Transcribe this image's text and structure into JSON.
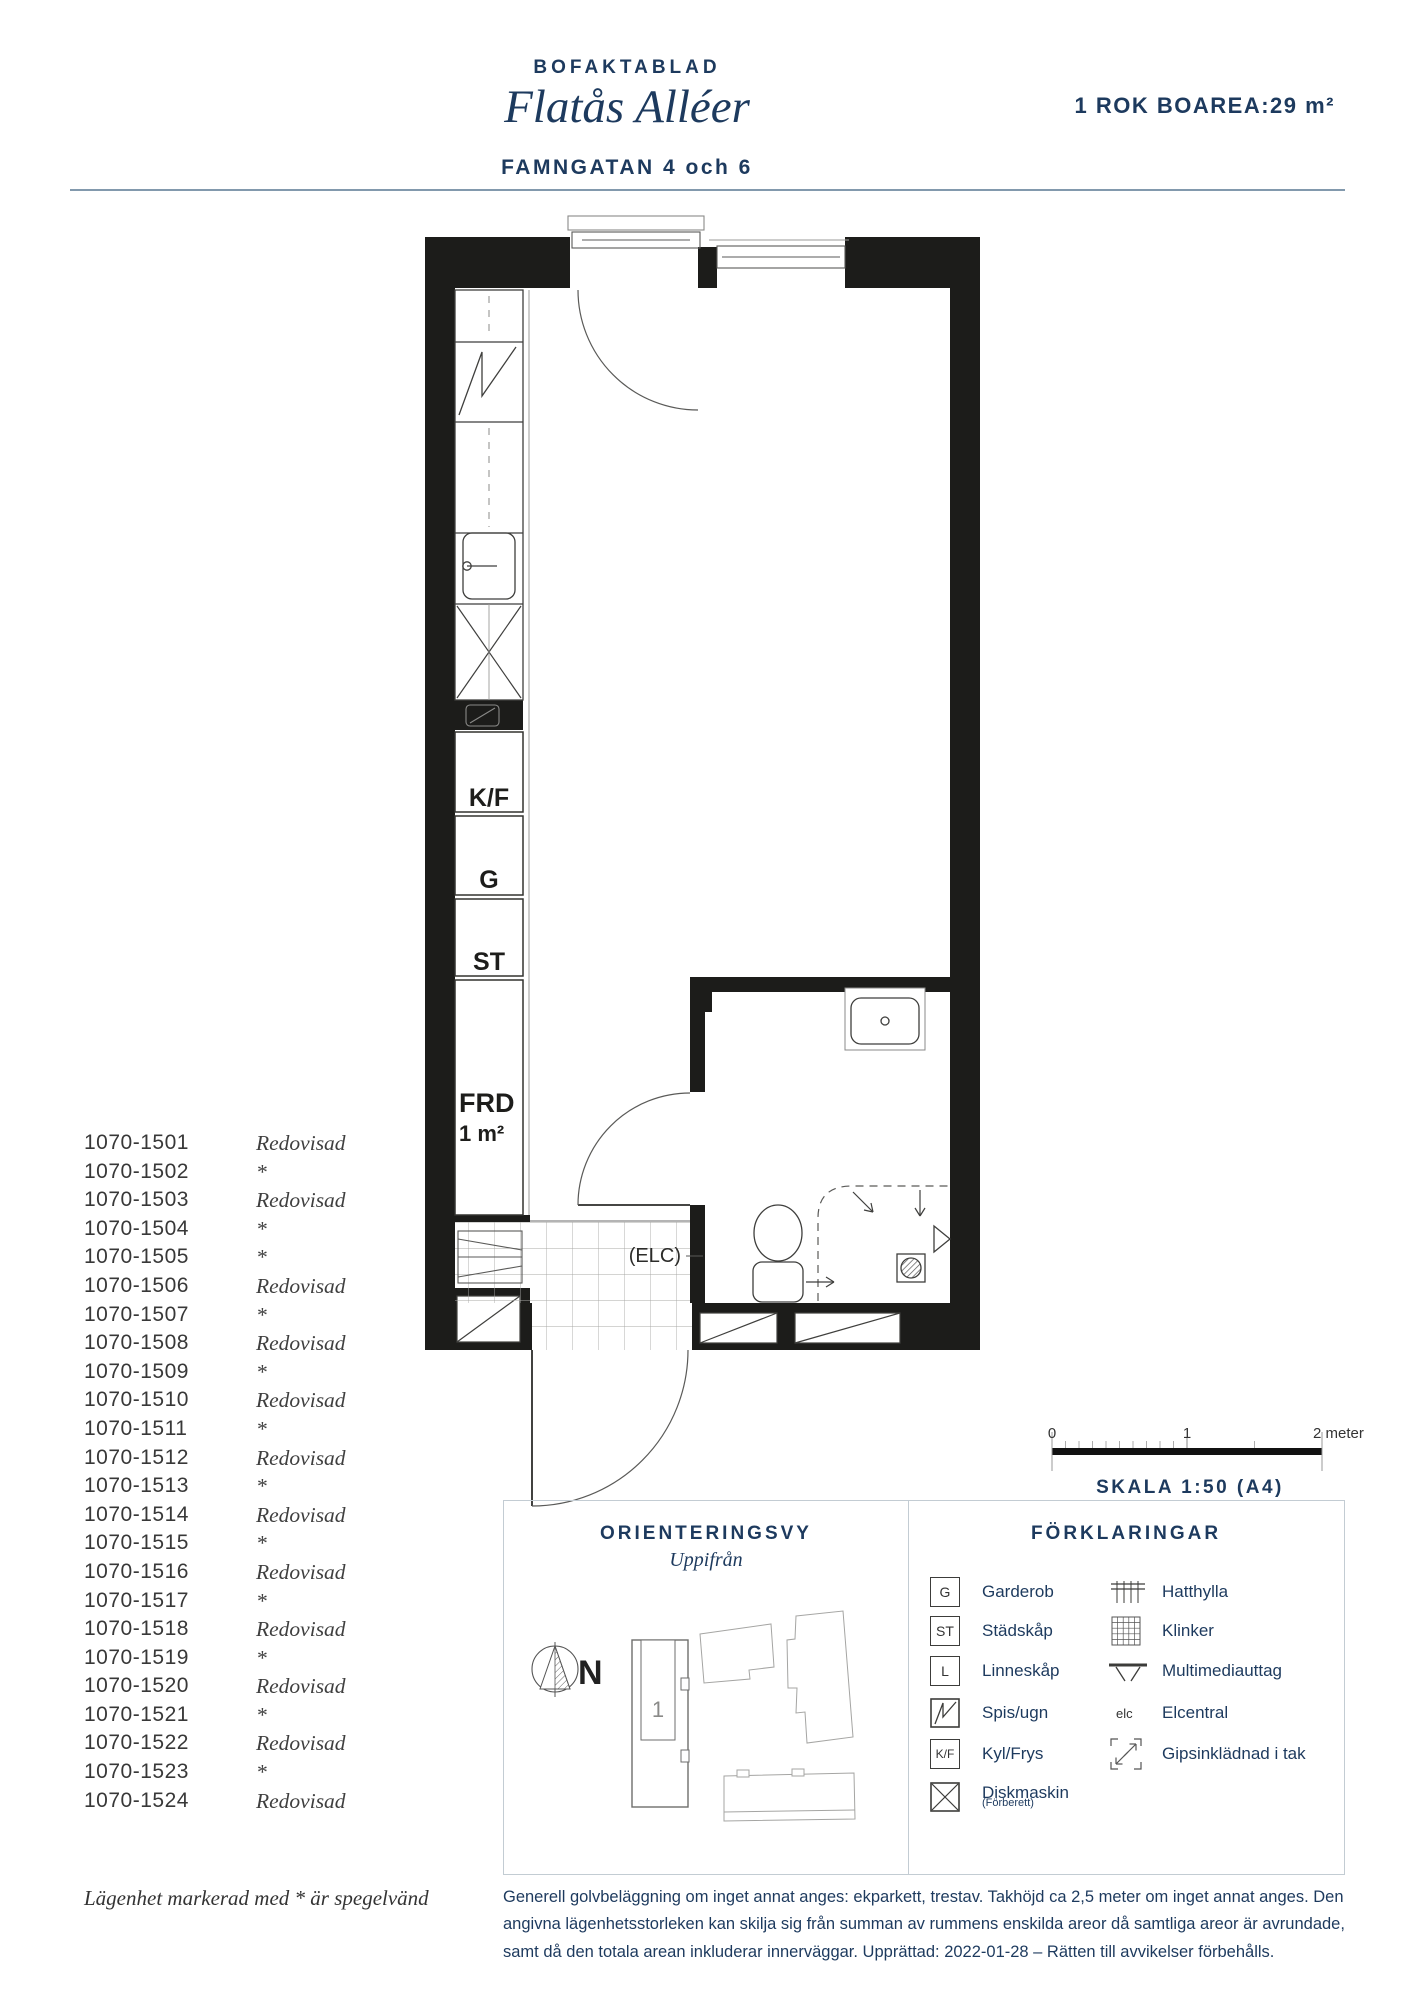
{
  "header": {
    "doc_type": "BOFAKTABLAD",
    "project": "Flatås Alléer",
    "address": "FAMNGATAN 4 och 6",
    "summary": "1 ROK BOAREA:29 m²"
  },
  "plan": {
    "labels": {
      "kf": "K/F",
      "g": "G",
      "st": "ST",
      "frd": "FRD",
      "frd_area": "1 m²",
      "elc": "(ELC)"
    }
  },
  "apartments": {
    "items": [
      {
        "id": "1070-1501",
        "status": "Redovisad"
      },
      {
        "id": "1070-1502",
        "status": "*"
      },
      {
        "id": "1070-1503",
        "status": "Redovisad"
      },
      {
        "id": "1070-1504",
        "status": "*"
      },
      {
        "id": "1070-1505",
        "status": "*"
      },
      {
        "id": "1070-1506",
        "status": "Redovisad"
      },
      {
        "id": "1070-1507",
        "status": "*"
      },
      {
        "id": "1070-1508",
        "status": "Redovisad"
      },
      {
        "id": "1070-1509",
        "status": "*"
      },
      {
        "id": "1070-1510",
        "status": "Redovisad"
      },
      {
        "id": "1070-1511",
        "status": "*"
      },
      {
        "id": "1070-1512",
        "status": "Redovisad"
      },
      {
        "id": "1070-1513",
        "status": "*"
      },
      {
        "id": "1070-1514",
        "status": "Redovisad"
      },
      {
        "id": "1070-1515",
        "status": "*"
      },
      {
        "id": "1070-1516",
        "status": "Redovisad"
      },
      {
        "id": "1070-1517",
        "status": "*"
      },
      {
        "id": "1070-1518",
        "status": "Redovisad"
      },
      {
        "id": "1070-1519",
        "status": "*"
      },
      {
        "id": "1070-1520",
        "status": "Redovisad"
      },
      {
        "id": "1070-1521",
        "status": "*"
      },
      {
        "id": "1070-1522",
        "status": "Redovisad"
      },
      {
        "id": "1070-1523",
        "status": "*"
      },
      {
        "id": "1070-1524",
        "status": "Redovisad"
      }
    ]
  },
  "scalebar": {
    "tick0": "0",
    "tick1": "1",
    "tick2": "2 meter",
    "label": "SKALA 1:50 (A4)"
  },
  "orientation": {
    "title": "ORIENTERINGSVY",
    "subtitle": "Uppifrån",
    "north": "N",
    "building_label": "1"
  },
  "legend": {
    "title": "FÖRKLARINGAR",
    "items_left": [
      {
        "icon": "box-letter",
        "symbol": "G",
        "label": "Garderob"
      },
      {
        "icon": "box-letter",
        "symbol": "ST",
        "label": "Städskåp"
      },
      {
        "icon": "box-letter",
        "symbol": "L",
        "label": "Linneskåp"
      },
      {
        "icon": "stove-zigzag",
        "symbol": "",
        "label": "Spis/ugn"
      },
      {
        "icon": "box-letter",
        "symbol": "K/F",
        "label": "Kyl/Frys"
      },
      {
        "icon": "box-x",
        "symbol": "",
        "label": "Diskmaskin",
        "sublabel": "(Förberett)"
      }
    ],
    "items_right": [
      {
        "icon": "hat-shelf",
        "label": "Hatthylla"
      },
      {
        "icon": "tile-grid",
        "label": "Klinker"
      },
      {
        "icon": "multimedia-outlet",
        "label": "Multimediauttag"
      },
      {
        "icon": "elc-text",
        "icon_text": "elc",
        "label": "Elcentral"
      },
      {
        "icon": "ceiling-plaster",
        "label": "Gipsinklädnad i tak"
      }
    ]
  },
  "footer": {
    "mirror_note": "Lägenhet markerad med * är spegelvänd",
    "disclaimer": "Generell golvbeläggning om inget annat anges: ekparkett, trestav. Takhöjd ca 2,5 meter om inget annat anges. Den angivna lägenhetsstorleken kan skilja sig från summan av rummens enskilda areor då samtliga areor är avrundade, samt då den totala arean inkluderar innerväggar. Upprättad: 2022-01-28 – Rätten till avvikelser förbehålls."
  },
  "colors": {
    "navy": "#1d3a5e",
    "wall_black": "#1c1c1a",
    "panel_border": "#c3ccd3"
  }
}
